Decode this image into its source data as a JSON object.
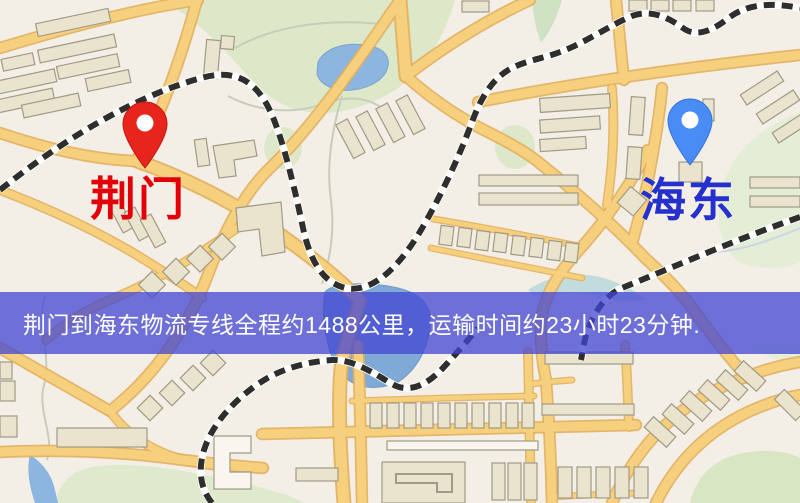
{
  "map": {
    "origin": {
      "label": "荆门",
      "pin_color": "#e8251d",
      "label_color": "#e30008"
    },
    "destination": {
      "label": "海东",
      "pin_color": "#4a8cf5",
      "label_color": "#2531cc"
    }
  },
  "banner": {
    "text": "荆门到海东物流专线全程约1488公里，运输时间约23小时23分钟.",
    "background": "#4246d3",
    "text_color": "#ffffff",
    "distance": "1488公里",
    "duration": "23小时23分钟"
  },
  "map_palette": {
    "background": "#f3efe6",
    "road": "#f7d07e",
    "road_casing": "#e2af5d",
    "park": "#dce8c8",
    "water": "#8cb5e0",
    "railway": "#2e2e2e",
    "building": "#eae3cd"
  }
}
